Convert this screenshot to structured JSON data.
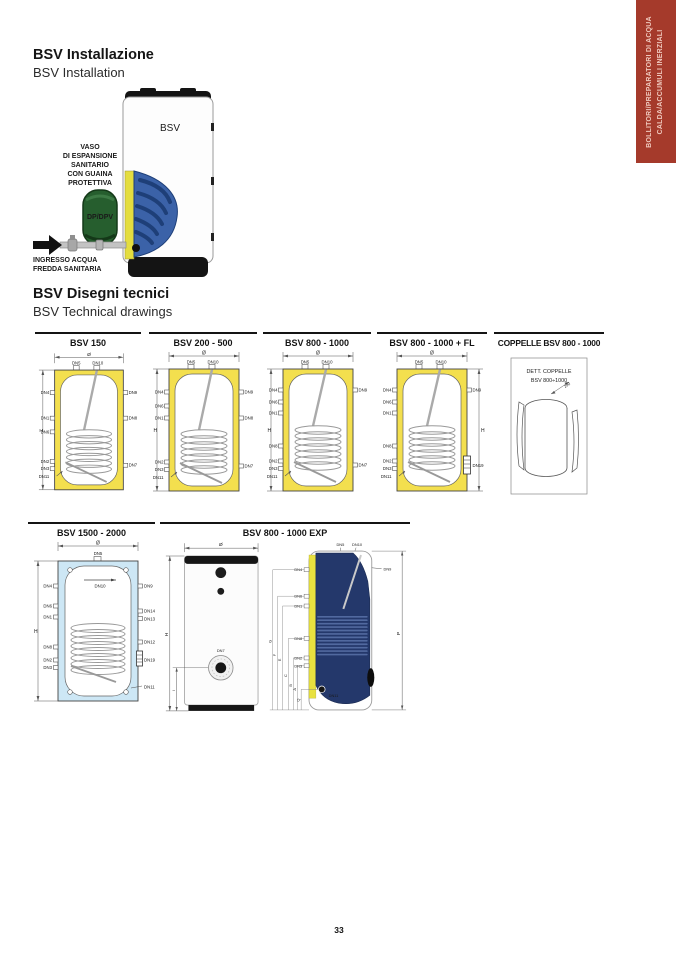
{
  "page": {
    "number": "33"
  },
  "side_tab": {
    "line1": "BOLLITORI/PREPARATORI DI ACQUA",
    "line2": "CALDA/ACCUMULI INERZIALI",
    "bg_color": "#A53A2B",
    "text_color": "#EFC8BD"
  },
  "installation": {
    "title_it": "BSV Installazione",
    "title_en": "BSV Installation",
    "tank_label": "BSV",
    "vessel_label": "DP/DPV",
    "expansion_label_lines": [
      "VASO",
      "DI ESPANSIONE",
      "SANITARIO",
      "CON GUAINA",
      "PROTETTIVA"
    ],
    "inlet_label_lines": [
      "INGRESSO ACQUA",
      "FREDDA SANITARIA"
    ]
  },
  "tech_section": {
    "title_it": "BSV Disegni tecnici",
    "title_en": "BSV Technical drawings"
  },
  "drawings": {
    "bsv150": {
      "header": "BSV 150",
      "dia": "Ø",
      "h": "H",
      "top": [
        "DN5",
        "DN10"
      ],
      "left": [
        "DN4",
        "DN1",
        "DN6",
        "DN2",
        "DN3",
        "DN11"
      ],
      "right": [
        "DN9",
        "DN8",
        "DN7"
      ]
    },
    "bsv200_500": {
      "header": "BSV 200 - 500",
      "dia": "Ø",
      "h": "H",
      "top": [
        "DN5",
        "DN10"
      ],
      "left": [
        "DN4",
        "DN6",
        "DN1",
        "DN2",
        "DN3",
        "DN11"
      ],
      "right": [
        "DN9",
        "DN8",
        "DN7"
      ]
    },
    "bsv800_1000": {
      "header": "BSV 800 - 1000",
      "dia": "Ø",
      "h": "H",
      "top": [
        "DN5",
        "DN10"
      ],
      "left": [
        "DN4",
        "DN6",
        "DN1",
        "DN8",
        "DN2",
        "DN3",
        "DN11"
      ],
      "right": [
        "DN9",
        "DN7"
      ]
    },
    "bsv800_1000_fl": {
      "header": "BSV 800 - 1000 + FL",
      "dia": "Ø",
      "h": "H",
      "top": [
        "DN5",
        "DN10"
      ],
      "left": [
        "DN4",
        "DN6",
        "DN1",
        "DN8",
        "DN2",
        "DN3",
        "DN11"
      ],
      "right": [
        "DN9",
        "DN19"
      ]
    },
    "coppelle": {
      "header": "COPPELLE BSV 800 - 1000",
      "box_line1": "DETT. COPPELLE",
      "box_line2": "BSV 800÷1000",
      "dim": "290"
    },
    "bsv1500_2000": {
      "header": "BSV 1500 - 2000",
      "dia": "Ø",
      "h": "H",
      "top": [
        "DN5"
      ],
      "inner": "DN10",
      "left": [
        "DN4",
        "DN6",
        "DN1",
        "DN8",
        "DN2",
        "DN3"
      ],
      "right": [
        "DN9",
        "DN14",
        "DN13",
        "DN12",
        "DN19",
        "DN11"
      ]
    },
    "bsv800_1000_exp": {
      "header": "BSV 800 - 1000 EXP",
      "front": {
        "dia": "Ø",
        "h": "H",
        "i": "I",
        "port": "DN7"
      },
      "cut": {
        "top": [
          "DN5",
          "DN10"
        ],
        "left": [
          "DN4",
          "DN6",
          "DN1",
          "DN8",
          "DN2",
          "DN3"
        ],
        "bottom_port": "DN11",
        "right_port": "DN9",
        "p": "P",
        "dims": [
          "G",
          "F",
          "E",
          "C",
          "B",
          "A",
          "Q"
        ]
      }
    }
  },
  "colors": {
    "drawing_yellow": "#F3DF4E",
    "drawing_blue": "#CDE7F5",
    "insulation_navy": "#24386B",
    "vessel_green": "#265E2E"
  }
}
